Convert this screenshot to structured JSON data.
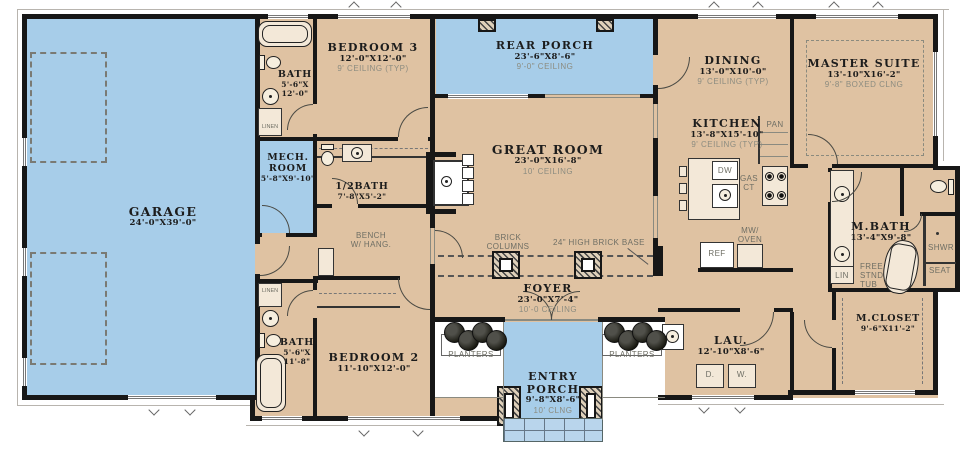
{
  "plan_title": "Single-story house floor plan",
  "colors": {
    "floor_beige": "#dfc2a2",
    "porch_blue": "#a7cde9",
    "wall_black": "#171717"
  },
  "rooms": {
    "garage": {
      "name": "GARAGE",
      "dim": "24'-0\"X39'-0\""
    },
    "bath_upper": {
      "name": "BATH",
      "dim_l1": "5'-6\"X",
      "dim_l2": "12'-0\""
    },
    "bedroom3": {
      "name": "BEDROOM 3",
      "dim": "12'-0\"X12'-0\"",
      "ceiling": "9' CEILING (TYP)"
    },
    "rear_porch": {
      "name": "REAR PORCH",
      "dim": "23'-6\"X8'-6\"",
      "ceiling": "9'-0\" CEILING"
    },
    "dining": {
      "name": "DINING",
      "dim": "13'-0\"X10'-0\"",
      "ceiling": "9' CEILING (TYP)"
    },
    "master_suite": {
      "name": "MASTER SUITE",
      "dim": "13'-10\"X16'-2\"",
      "ceiling": "9'-8\" BOXED CLNG"
    },
    "mech_room": {
      "name_l1": "MECH.",
      "name_l2": "ROOM",
      "dim": "5'-8\"X9'-10\""
    },
    "half_bath": {
      "name": "1/2BATH",
      "dim": "7'-8\"X5'-2\""
    },
    "great_room": {
      "name": "GREAT ROOM",
      "dim": "23'-0\"X16'-8\"",
      "ceiling": "10' CEILING"
    },
    "kitchen": {
      "name": "KITCHEN",
      "dim": "13'-8\"X15'-10\"",
      "ceiling": "9' CEILING (TYP)"
    },
    "master_bath": {
      "name": "M.BATH",
      "dim": "13'-4\"X9'-8\""
    },
    "foyer": {
      "name": "FOYER",
      "dim": "23'-0\"X7'-4\"",
      "ceiling": "10'-0 CEILING"
    },
    "bedroom2": {
      "name": "BEDROOM 2",
      "dim": "11'-10\"X12'-0\""
    },
    "bath_lower": {
      "name": "BATH",
      "dim_l1": "5'-6\"X",
      "dim_l2": "11'-8\""
    },
    "laundry": {
      "name": "LAU.",
      "dim": "12'-10\"X8'-6\""
    },
    "master_closet": {
      "name": "M.CLOSET",
      "dim": "9'-6\"X11'-2\""
    },
    "entry_porch": {
      "name_l1": "ENTRY",
      "name_l2": "PORCH",
      "dim": "9'-8\"X8'-6\"",
      "ceiling": "10' CLNG"
    }
  },
  "annotations": {
    "brick_columns_l1": "BRICK",
    "brick_columns_l2": "COLUMNS",
    "brick_base": "24\" HIGH BRICK BASE",
    "bench_l1": "BENCH",
    "bench_l2": "W/ HANG.",
    "planters_left": "PLANTERS",
    "planters_right": "PLANTERS",
    "free_tub_l1": "FREE",
    "free_tub_l2": "STND",
    "free_tub_l3": "TUB",
    "shower_l1": "SHWR",
    "shower_l2": "SEAT",
    "lin": "LIN",
    "linen_upper": "LINEN",
    "linen_lower": "LINEN",
    "pantry": "PAN",
    "dishwasher": "DW",
    "gas_l1": "GAS",
    "gas_l2": "CT",
    "fridge": "REF",
    "mw_l1": "MW/",
    "mw_l2": "OVEN",
    "dryer": "D.",
    "washer": "W."
  }
}
